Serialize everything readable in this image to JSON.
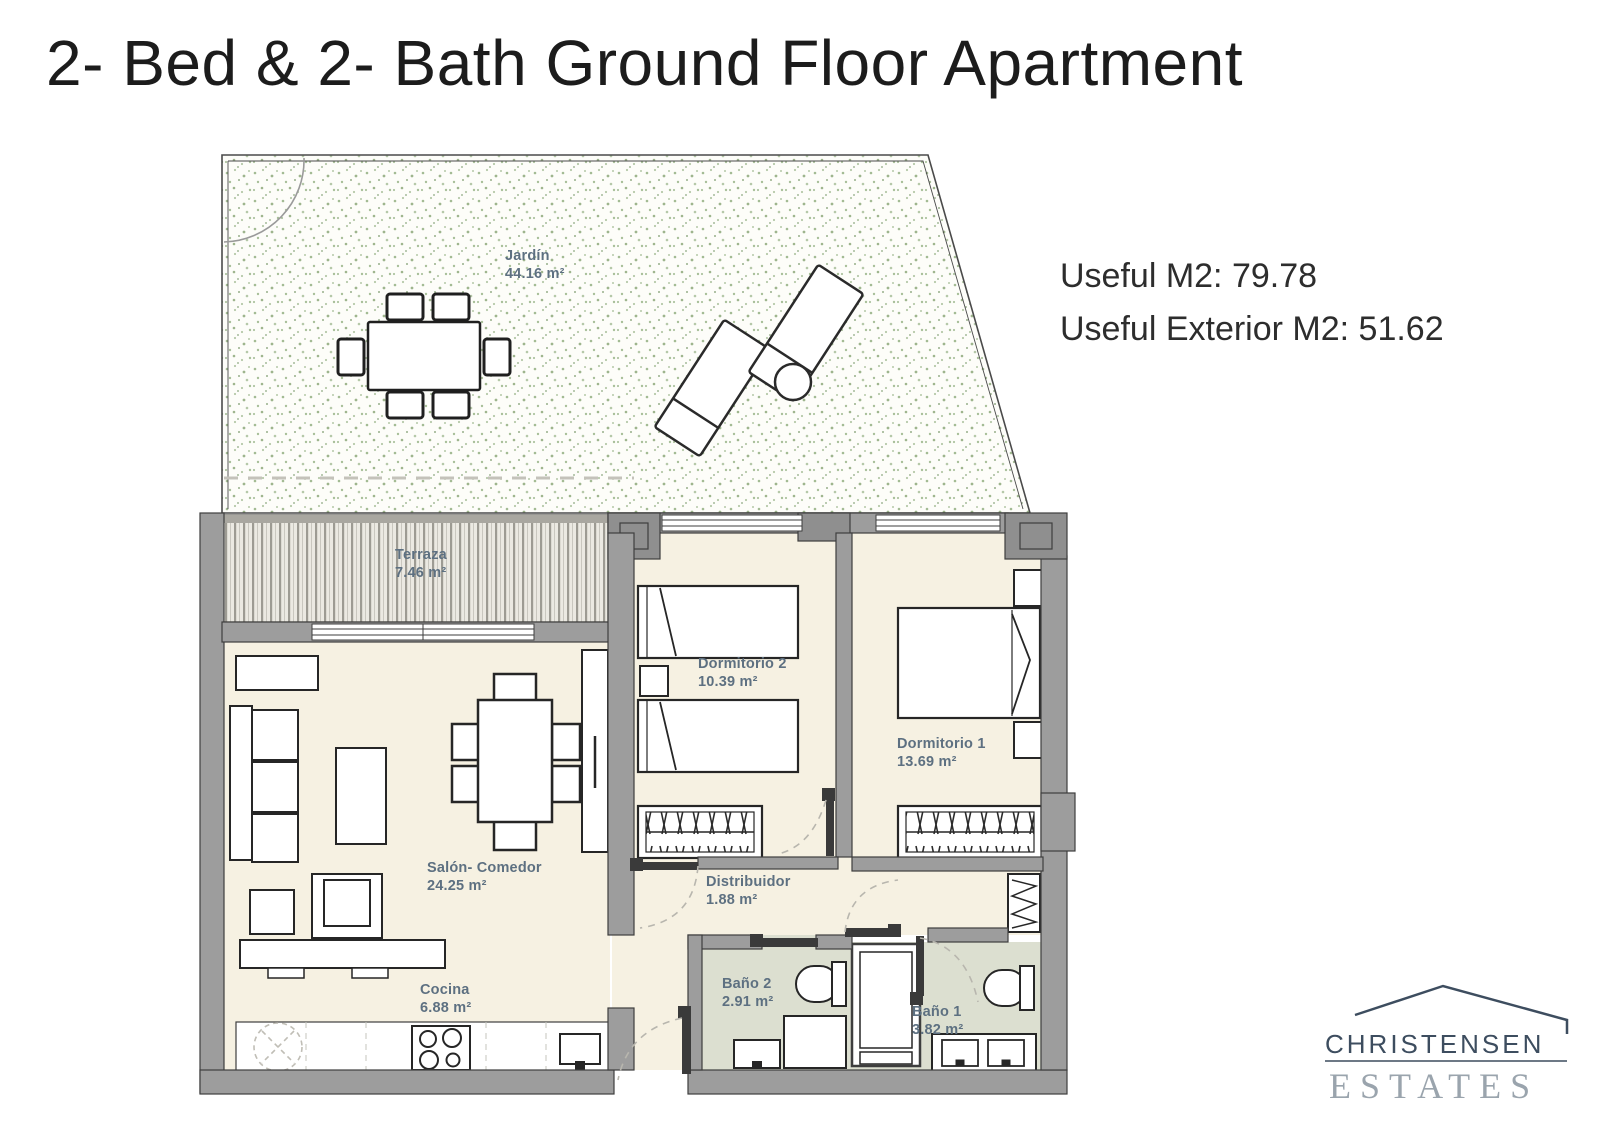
{
  "page": {
    "title": "2- Bed & 2- Bath Ground Floor Apartment"
  },
  "area_info": {
    "line1": "Useful M2: 79.78",
    "line2": "Useful Exterior M2: 51.62"
  },
  "floorplan": {
    "rooms": [
      {
        "id": "jardin",
        "name": "Jardín",
        "area": "44.16 m²"
      },
      {
        "id": "terraza",
        "name": "Terraza",
        "area": "7.46 m²"
      },
      {
        "id": "dormitorio2",
        "name": "Dormitorio 2",
        "area": "10.39 m²"
      },
      {
        "id": "dormitorio1",
        "name": "Dormitorio 1",
        "area": "13.69 m²"
      },
      {
        "id": "salon",
        "name": "Salón- Comedor",
        "area": "24.25 m²"
      },
      {
        "id": "distribuidor",
        "name": "Distribuidor",
        "area": "1.88 m²"
      },
      {
        "id": "cocina",
        "name": "Cocina",
        "area": "6.88 m²"
      },
      {
        "id": "bano2",
        "name": "Baño 2",
        "area": "2.91 m²"
      },
      {
        "id": "bano1",
        "name": "Baño 1",
        "area": "3.82 m²"
      }
    ],
    "colors": {
      "wall": "#9d9d9d",
      "floor": "#f6f1e2",
      "bath_floor": "#dcdfd0",
      "garden_speckle": "#85a571",
      "label": "#5d7081"
    }
  },
  "logo": {
    "name": "CHRISTENSEN",
    "subname": "ESTATES",
    "color_primary": "#3d4d5f",
    "color_secondary": "#9aa4ad"
  }
}
